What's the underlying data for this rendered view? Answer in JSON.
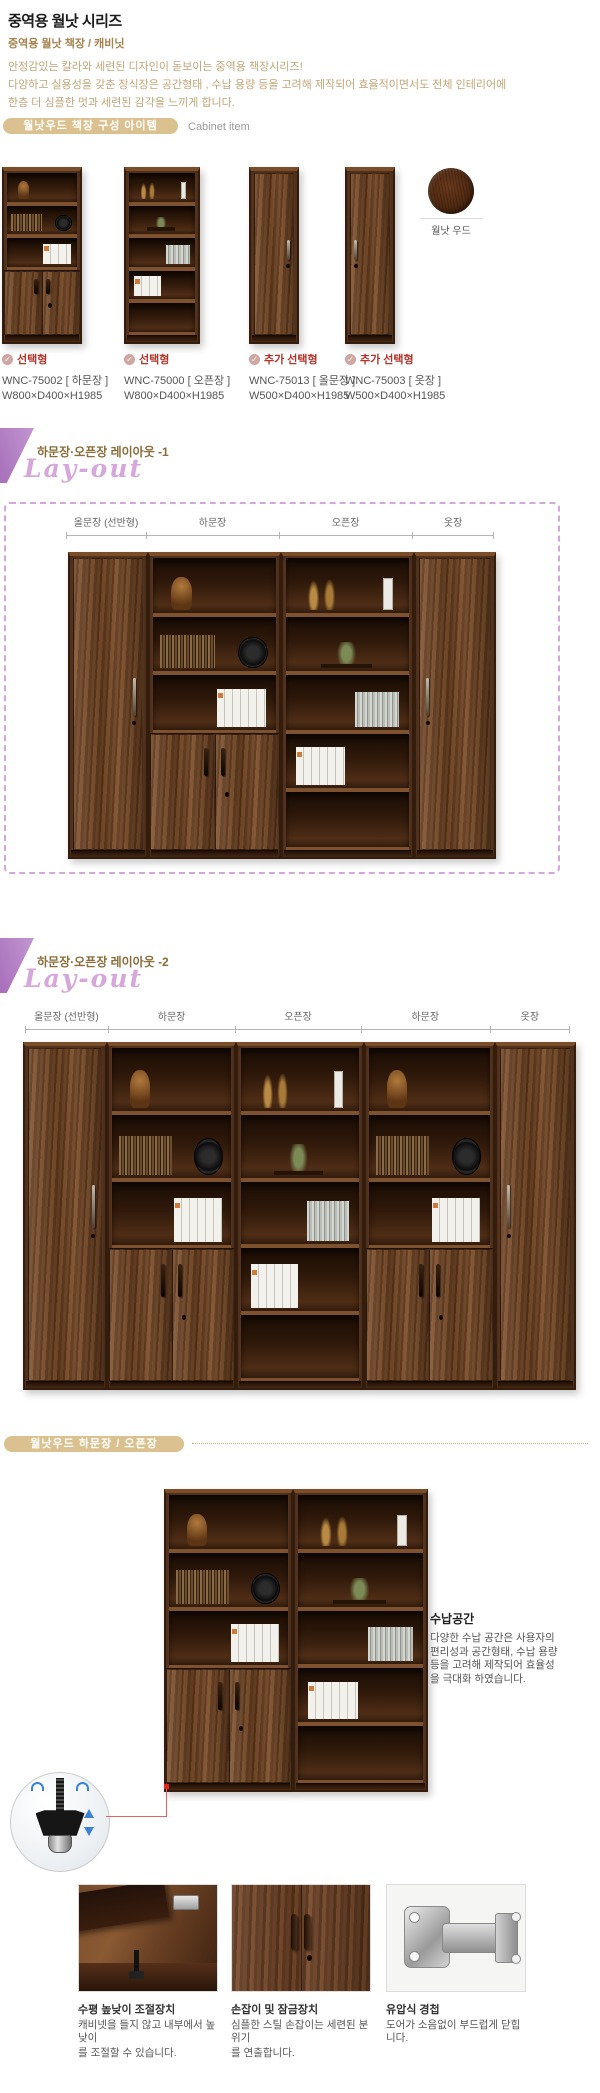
{
  "header": {
    "title": "중역용 월낫 시리즈",
    "subtitle": "중역용 월낫 책장 / 캐비닛",
    "desc": [
      "안정감있는 칼라와 세련된 디자인이 돋보이는 중역용 책장시리즈!",
      "다양하고 실용성을 갖춘 장식장은 공간형태 , 수납 용량 등을 고려해 제작되어 효율적이면서도 전체 인테리어에",
      "한층 더 심플한 멋과 세련된 감각을 느끼게 합니다."
    ]
  },
  "section_items": {
    "pill_label": "월낫우드 책장 구성 아이템",
    "side_label": "Cabinet item",
    "swatch_label": "월낫 우드",
    "products": [
      {
        "type": "선택형",
        "model": "WNC-75002",
        "variant": "[ 하문장 ]",
        "size": "W800×D400×H1985",
        "cabinet": "lower_door"
      },
      {
        "type": "선택형",
        "model": "WNC-75000",
        "variant": "[ 오픈장 ]",
        "size": "W800×D400×H1985",
        "cabinet": "open"
      },
      {
        "type": "추가 선택형",
        "model": "WNC-75013",
        "variant": "[ 올문장 ]",
        "size": "W500×D400×H1985",
        "cabinet": "full_door"
      },
      {
        "type": "추가 선택형",
        "model": "WNC-75003",
        "variant": "[ 옷장 ]",
        "size": "W500×D400×H1985",
        "cabinet": "wardrobe"
      }
    ]
  },
  "layout1": {
    "title": "하문장·오픈장 레이아웃 -1",
    "script_label": "Lay-out",
    "segments": [
      {
        "label": "올문장 (선반형)",
        "w": 18.7,
        "cabinet": "full_door"
      },
      {
        "label": "하문장",
        "w": 31.1,
        "cabinet": "lower_door"
      },
      {
        "label": "오픈장",
        "w": 31.1,
        "cabinet": "open"
      },
      {
        "label": "옷장",
        "w": 19.1,
        "cabinet": "wardrobe"
      }
    ]
  },
  "layout2": {
    "title": "하문장·오픈장 레이아웃 -2",
    "script_label": "Lay-out",
    "segments": [
      {
        "label": "올문장 (선반형)",
        "w": 15.2,
        "cabinet": "full_door"
      },
      {
        "label": "하문장",
        "w": 23.4,
        "cabinet": "lower_door"
      },
      {
        "label": "오픈장",
        "w": 23.0,
        "cabinet": "open"
      },
      {
        "label": "하문장",
        "w": 23.7,
        "cabinet": "lower_door"
      },
      {
        "label": "옷장",
        "w": 14.7,
        "cabinet": "wardrobe"
      }
    ]
  },
  "detail": {
    "pill_label": "월낫우드 하문장 / 오픈장",
    "pair": [
      {
        "cabinet": "lower_door",
        "w": 49
      },
      {
        "cabinet": "open",
        "w": 51
      }
    ],
    "storage": {
      "title": "수납공간",
      "lines": [
        "다양한 수납 공간은 사용자의",
        "편리성과 공간형태, 수납 용량",
        "등을 고려해 제작되어 효율성",
        "을 극대화 하였습니다."
      ]
    }
  },
  "features": [
    {
      "title": "수평 높낮이 조절장치",
      "lines": [
        "캐비넷을 들지 않고 내부에서 높낮이",
        "를 조절할 수 있습니다."
      ],
      "image": "leveler"
    },
    {
      "title": "손잡이 및 잠금장치",
      "lines": [
        "심플한 스틸 손잡이는 세련된 분위기",
        "를 연출합니다."
      ],
      "image": "handles"
    },
    {
      "title": "유압식 경첩",
      "lines": [
        "도어가 소음없이 부드럽게 닫힙니다."
      ],
      "image": "hinge"
    }
  ],
  "colors": {
    "pill_bg": "#dbc18f",
    "accent_red": "#b23329",
    "purple": "#b181c4",
    "script_pink": "#d6a7da",
    "wood_dark": "#5d3017",
    "desc_tan": "#c2a678"
  }
}
